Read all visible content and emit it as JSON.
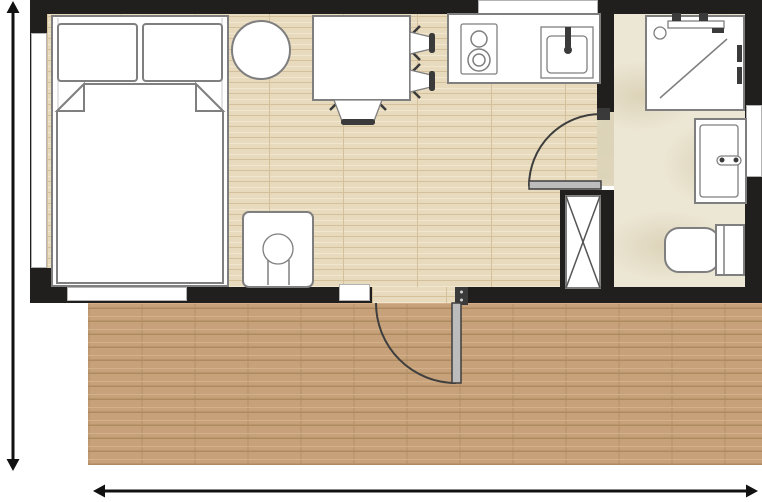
{
  "floorplan": {
    "type": "studio-unit-with-terrace",
    "rooms": [
      {
        "name": "main-room",
        "zones": [
          "sleeping",
          "dining",
          "kitchen"
        ],
        "floor_material": "light-wood-planks"
      },
      {
        "name": "bathroom",
        "floor_material": "beige-stone-tile"
      },
      {
        "name": "terrace",
        "floor_material": "brown-wood-decking"
      }
    ],
    "furniture_symbols": [
      {
        "name": "double-bed",
        "room": "main-room",
        "details": [
          "two-pillows",
          "duvet-with-folded-corners"
        ]
      },
      {
        "name": "round-table",
        "room": "main-room"
      },
      {
        "name": "dining-table",
        "room": "main-room"
      },
      {
        "name": "dining-chair",
        "room": "main-room",
        "count": 3
      },
      {
        "name": "washing-machine",
        "room": "main-room"
      },
      {
        "name": "kitchen-counter",
        "room": "main-room"
      },
      {
        "name": "two-burner-cooktop",
        "room": "main-room"
      },
      {
        "name": "kitchen-sink-with-faucet",
        "room": "main-room"
      },
      {
        "name": "shower-cabin",
        "room": "bathroom"
      },
      {
        "name": "washbasin-with-faucet",
        "room": "bathroom"
      },
      {
        "name": "toilet-with-cistern",
        "room": "bathroom"
      },
      {
        "name": "technical-shaft",
        "room": "wall-between-main-room-and-bathroom"
      }
    ],
    "openings": {
      "windows": [
        {
          "name": "left-wall-window"
        },
        {
          "name": "bedroom-bottom-window"
        },
        {
          "name": "entry-sidelight-window"
        },
        {
          "name": "kitchen-top-window"
        },
        {
          "name": "bathroom-right-window"
        }
      ],
      "doors": [
        {
          "name": "entry-door",
          "location": "bottom-wall",
          "swing": "outward-onto-terrace"
        },
        {
          "name": "bathroom-door",
          "location": "interior-wall",
          "swing": "into-main-room"
        }
      ]
    },
    "annotations": {
      "dimension_arrows": [
        {
          "name": "height-dimension-arrow",
          "orientation": "vertical",
          "position": "left",
          "style": "double-headed"
        },
        {
          "name": "width-dimension-arrow",
          "orientation": "horizontal",
          "position": "bottom",
          "style": "double-headed"
        }
      ],
      "labels": []
    },
    "colors": {
      "background": "#ffffff",
      "wall": "#211f1d",
      "wood_floor": "#e8dabd",
      "wood_floor_line": "#d5c09c",
      "wood_floor_light": "#f1e7d0",
      "terrace": "#c7a179",
      "terrace_line": "#ae8a61",
      "terrace_light": "#d3b089",
      "bath_floor": "#ece6d4",
      "bath_floor_swirl": "#dcd3b8",
      "fixture_stroke": "#7f7f7f",
      "dark_detail": "#3a3a3a",
      "window_line": "#b3b3b3",
      "dimension": "#111111",
      "door_leaf": "#bcbcbc"
    }
  }
}
